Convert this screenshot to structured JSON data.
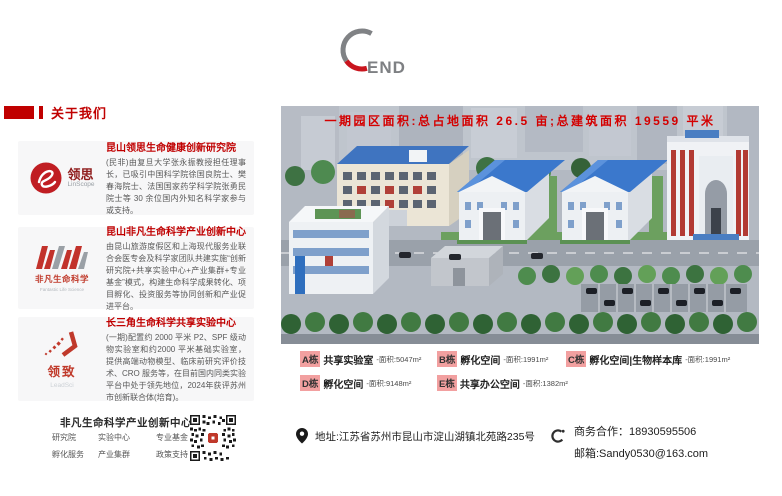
{
  "header": {
    "end_label": "END"
  },
  "about": {
    "header": "关于我们",
    "sections": [
      {
        "logo_text": "领思",
        "logo_sub": "LinScope",
        "title": "昆山领思生命健康创新研究院",
        "body": "(民非)由复旦大学张永振教授担任理事长，已吸引中国科学院徐国良院士、樊春海院士、法国国家药学科学院张勇民院士等 30 余位国内外知名科学家参与或支持。"
      },
      {
        "logo_text": "非凡生命科学",
        "logo_sub": "Fantastic Life Science",
        "title": "昆山非凡生命科学产业创新中心",
        "body": "由昆山旅游度假区和上海现代服务业联合会医专会及科学家团队共建实施“创新研究院+共享实验中心+产业集群+专业基金”模式，构建生命科学成果转化、项目孵化、投资服务等协同创新和产业促进平台。"
      },
      {
        "logo_text": "领致",
        "logo_sub": "LeadSci",
        "title": "长三角生命科学共享实验中心",
        "body": "(一期)配置约 2000 平米 P2、SPF 级动物实验室和约2000 平米基础实验室，提供高端动物模型、临床前研究评价技术、CRO 服务等，在目前国内同类实验平台中处于领先地位，2024年获评苏州市创新联合体(培育)。"
      }
    ]
  },
  "campus": {
    "banner": "一期园区面积:总占地面积 26.5 亩;总建筑面积 19559 平米",
    "buildings": [
      {
        "tag": "A栋",
        "name": "共享实验室",
        "area": "-面积:5047m²"
      },
      {
        "tag": "B栋",
        "name": "孵化空间",
        "area": "-面积:1991m²"
      },
      {
        "tag": "C栋",
        "name": "孵化空间|生物样本库",
        "area": "-面积:1991m²"
      },
      {
        "tag": "D栋",
        "name": "孵化空间",
        "area": "-面积:9148m²"
      },
      {
        "tag": "E栋",
        "name": "共享办公空间",
        "area": "-面积:1382m²"
      }
    ]
  },
  "footer": {
    "org": "非凡生命科学产业创新中心",
    "features": [
      "研究院",
      "实验中心",
      "专业基金",
      "孵化服务",
      "产业集群",
      "政策支持"
    ],
    "address": "地址:江苏省苏州市昆山市淀山湖镇北苑路235号",
    "business": "商务合作：18930595506",
    "email": "邮箱:Sandy0530@163.com"
  },
  "colors": {
    "accent_red": "#c00000",
    "banner_red": "#d40000",
    "tag_pink": "#f2a0a0",
    "roof_blue": "#3b78cc"
  }
}
